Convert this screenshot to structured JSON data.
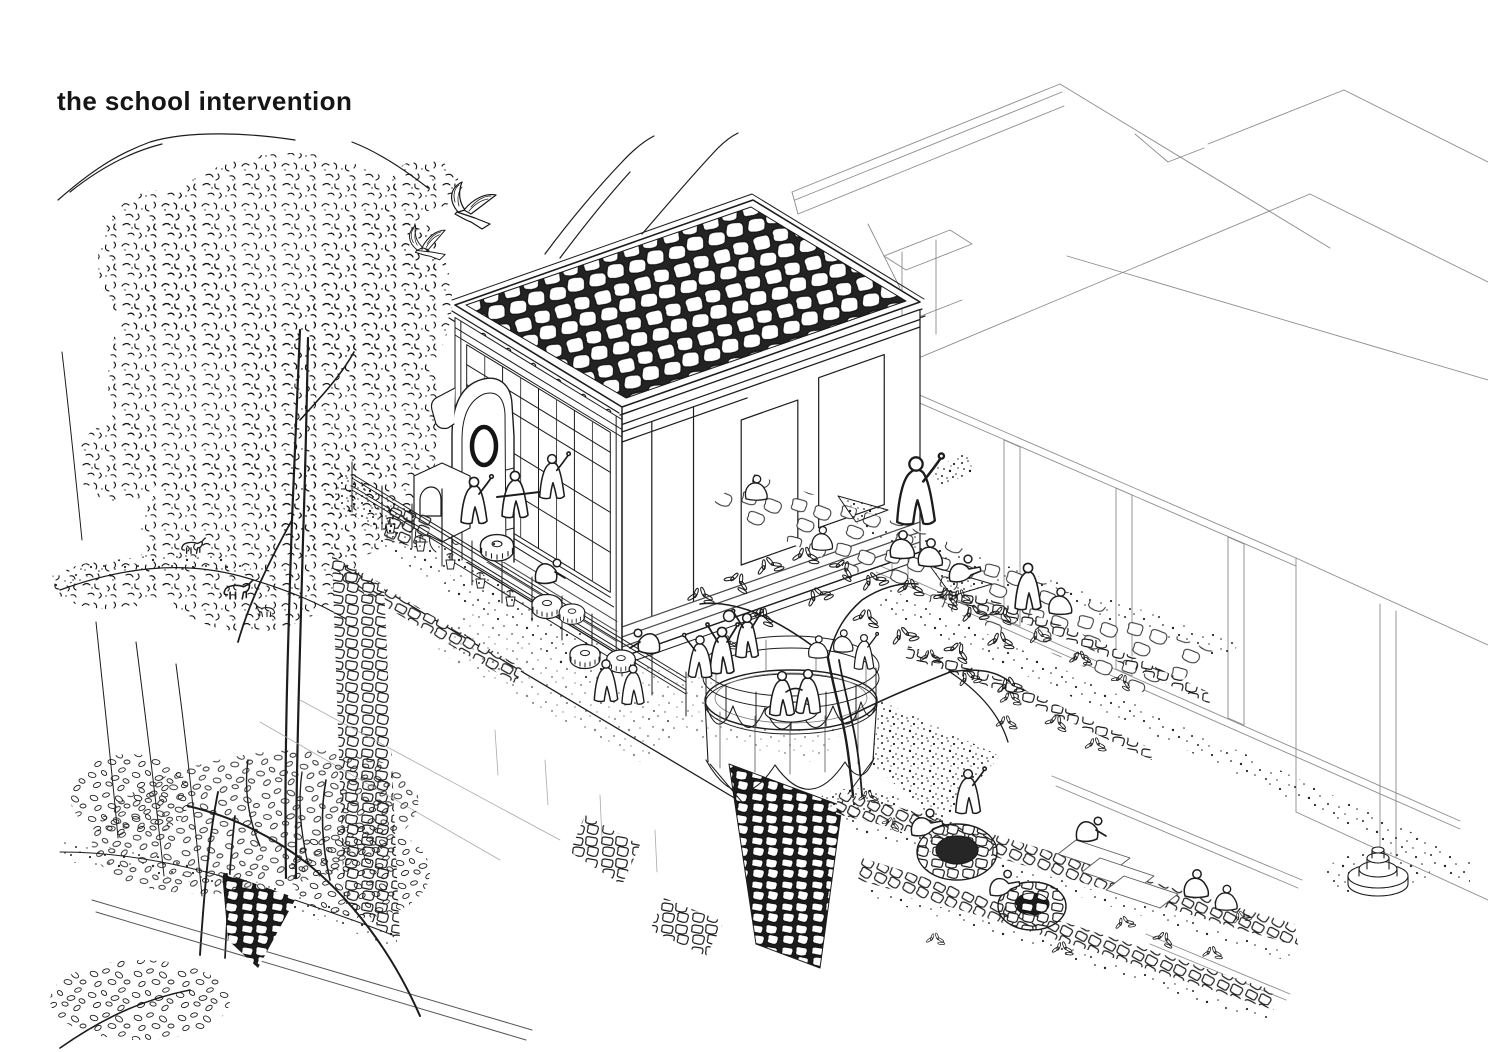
{
  "title": {
    "text": "the school intervention"
  },
  "palette": {
    "background": "#ffffff",
    "ink": "#1c1c1c",
    "light_line": "#8c8c8c"
  },
  "scene": {
    "type": "hand-drawn isometric architectural illustration, black ink on white",
    "elements": [
      {
        "name": "mountain-contours",
        "desc": "wavy ridge and cliff lines, upper left and top center"
      },
      {
        "name": "large-tree",
        "desc": "dense scribbled foliage tree on the left with tall trunk"
      },
      {
        "name": "flying-birds",
        "desc": "two hatched birds in flight near top center-left"
      },
      {
        "name": "grazing-goats",
        "desc": "small livestock on the upper meadow"
      },
      {
        "name": "school-building",
        "desc": "new school: cobblestone roof, gridded glazed facade, stone patch walls, stone arch hearth and clay oven"
      },
      {
        "name": "existing-school-blocks",
        "desc": "thin-line flat roof planes and colonnade wall at right"
      },
      {
        "name": "planted-fence",
        "desc": "double-rail fence with potted plants along the courtyard"
      },
      {
        "name": "grinding-stones",
        "desc": "round fluted stones in the courtyard"
      },
      {
        "name": "dance-platform",
        "desc": "round deck with railing, scalloped skirt and stone masonry pier, two dancers"
      },
      {
        "name": "courtyard-tree",
        "desc": "branching tree with leaf sprays beside the platform, children climbing"
      },
      {
        "name": "ball-game",
        "desc": "figures with raised arms playing with a ball"
      },
      {
        "name": "garden-path",
        "desc": "flagstone path with seated and standing figures"
      },
      {
        "name": "terraced-garden",
        "desc": "snaking stone walls, two round stone wells, stepping slabs, working figures"
      },
      {
        "name": "fountain-pedestal",
        "desc": "small tiered round pedestal at lower right"
      },
      {
        "name": "retaining-wall",
        "desc": "large blank retaining wall face with stone crest at lower left"
      }
    ]
  }
}
